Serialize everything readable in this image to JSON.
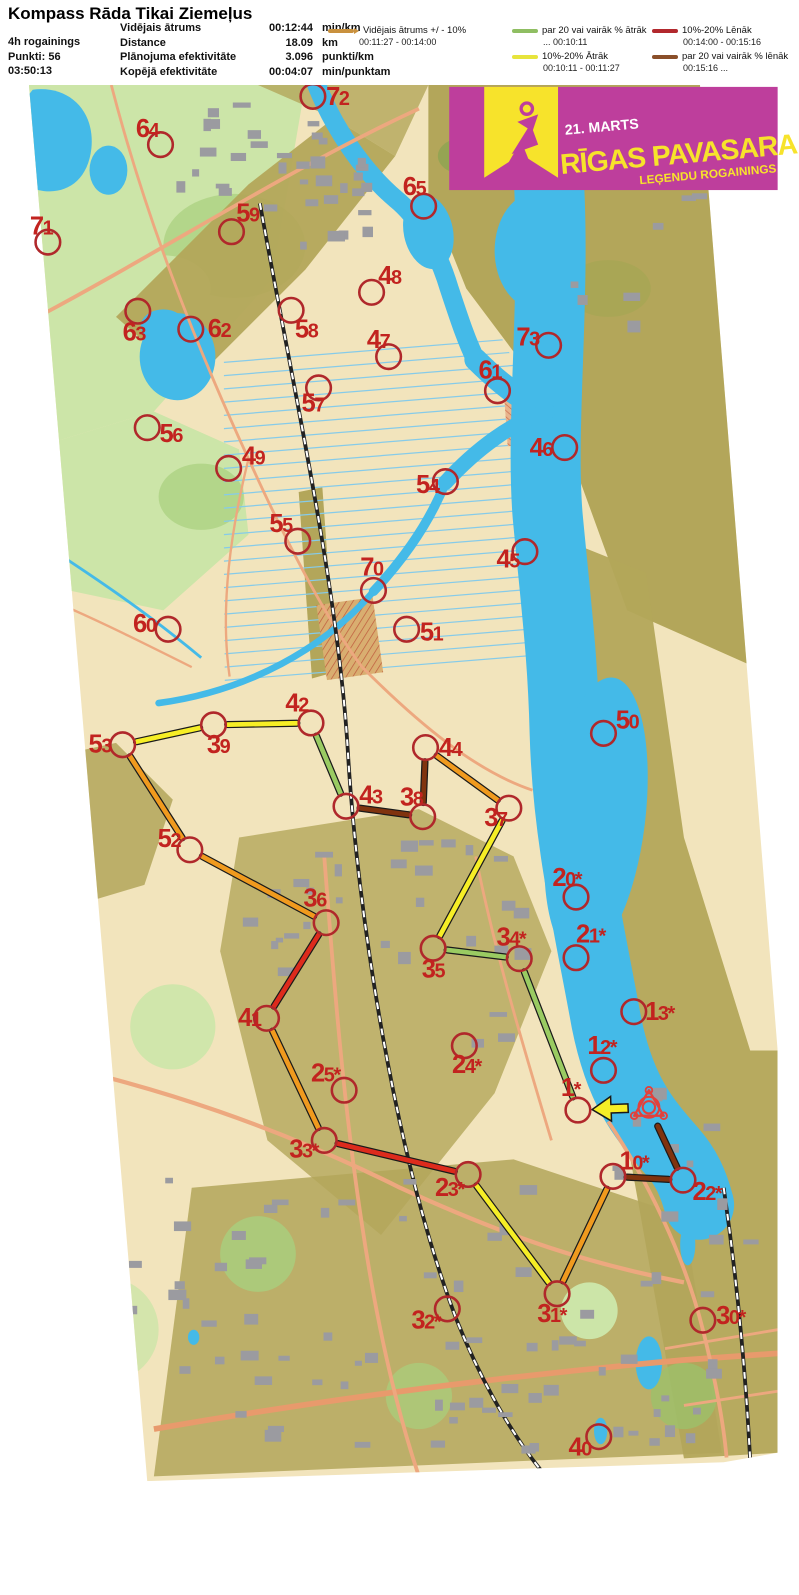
{
  "header": {
    "title": "Kompass Rāda Tikai Ziemeļus",
    "left": [
      "4h rogainings",
      "Punkti: 56",
      "03:50:13"
    ],
    "stats": [
      {
        "label": "Vidējais ātrums",
        "value": "00:12:44",
        "unit": "min/km"
      },
      {
        "label": "Distance",
        "value": "18.09",
        "unit": "km"
      },
      {
        "label": "Plānojuma efektivitāte",
        "value": "3.096",
        "unit": "punkti/km"
      },
      {
        "label": "Kopējā efektivitāte",
        "value": "00:04:07",
        "unit": "min/punktam"
      }
    ],
    "legend": [
      {
        "label": "Vidējais ātrums +/ - 10%",
        "range": "00:11:27  -  00:14:00",
        "color": "#C9913E"
      },
      {
        "label": "par 20 vai vairāk % ātrāk",
        "range": "...  00:10:11",
        "color": "#8FBE62"
      },
      {
        "label": "10%-20% Ātrāk",
        "range": "00:10:11  -  00:11:27",
        "color": "#E7E43C"
      },
      {
        "label": "10%-20% Lēnāk",
        "range": "00:14:00  -  00:15:16",
        "color": "#B2282D"
      },
      {
        "label": "par 20 vai vairāk % lēnāk",
        "range": "00:15:16  ...",
        "color": "#8A4F2A"
      }
    ]
  },
  "banner": {
    "date": "21. MARTS",
    "title": "RĪGAS PAVASARA",
    "subtitle": "LEĢENDU ROGAININGS",
    "bg_color": "#BE3E9C",
    "accent_color": "#F7E32B"
  },
  "map": {
    "palette": {
      "orange": "#F09A1E",
      "yellow": "#F6EE26",
      "green": "#9ACB62",
      "red": "#DD2B1C",
      "brown": "#80330E",
      "circle": "#B0282B",
      "label": "#C2231F",
      "start": "#E2413C"
    },
    "start_finish": {
      "x": 663,
      "y": 1165
    },
    "controls": [
      {
        "id": "71",
        "x": 28,
        "y": 251,
        "lx": 9,
        "ly": 243
      },
      {
        "id": "64",
        "x": 147,
        "y": 148,
        "lx": 121,
        "ly": 140
      },
      {
        "id": "72",
        "x": 308,
        "y": 97,
        "lx": 322,
        "ly": 106
      },
      {
        "id": "65",
        "x": 425,
        "y": 213,
        "lx": 403,
        "ly": 201
      },
      {
        "id": "59",
        "x": 222,
        "y": 240,
        "lx": 227,
        "ly": 229
      },
      {
        "id": "63",
        "x": 123,
        "y": 324,
        "lx": 107,
        "ly": 355
      },
      {
        "id": "62",
        "x": 179,
        "y": 343,
        "lx": 197,
        "ly": 351
      },
      {
        "id": "58",
        "x": 285,
        "y": 323,
        "lx": 289,
        "ly": 352
      },
      {
        "id": "48",
        "x": 370,
        "y": 304,
        "lx": 377,
        "ly": 295
      },
      {
        "id": "47",
        "x": 388,
        "y": 372,
        "lx": 365,
        "ly": 363
      },
      {
        "id": "73",
        "x": 557,
        "y": 360,
        "lx": 523,
        "ly": 360
      },
      {
        "id": "61",
        "x": 503,
        "y": 408,
        "lx": 483,
        "ly": 395
      },
      {
        "id": "57",
        "x": 314,
        "y": 405,
        "lx": 296,
        "ly": 430
      },
      {
        "id": "56",
        "x": 133,
        "y": 447,
        "lx": 146,
        "ly": 462
      },
      {
        "id": "49",
        "x": 219,
        "y": 490,
        "lx": 233,
        "ly": 486
      },
      {
        "id": "46",
        "x": 574,
        "y": 468,
        "lx": 537,
        "ly": 477
      },
      {
        "id": "54",
        "x": 448,
        "y": 504,
        "lx": 417,
        "ly": 516
      },
      {
        "id": "55",
        "x": 292,
        "y": 567,
        "lx": 262,
        "ly": 557
      },
      {
        "id": "45",
        "x": 532,
        "y": 578,
        "lx": 502,
        "ly": 595
      },
      {
        "id": "70",
        "x": 372,
        "y": 619,
        "lx": 358,
        "ly": 603
      },
      {
        "id": "60",
        "x": 155,
        "y": 660,
        "lx": 118,
        "ly": 663
      },
      {
        "id": "51",
        "x": 407,
        "y": 660,
        "lx": 421,
        "ly": 672
      },
      {
        "id": "50",
        "x": 615,
        "y": 770,
        "lx": 628,
        "ly": 765
      },
      {
        "id": "42",
        "x": 306,
        "y": 759,
        "lx": 279,
        "ly": 747
      },
      {
        "id": "39",
        "x": 203,
        "y": 761,
        "lx": 196,
        "ly": 791
      },
      {
        "id": "53",
        "x": 107,
        "y": 782,
        "lx": 71,
        "ly": 790
      },
      {
        "id": "44",
        "x": 427,
        "y": 785,
        "lx": 441,
        "ly": 794
      },
      {
        "id": "43",
        "x": 343,
        "y": 847,
        "lx": 357,
        "ly": 844
      },
      {
        "id": "38",
        "x": 424,
        "y": 858,
        "lx": 400,
        "ly": 846
      },
      {
        "id": "37",
        "x": 515,
        "y": 849,
        "lx": 489,
        "ly": 868
      },
      {
        "id": "52",
        "x": 178,
        "y": 893,
        "lx": 144,
        "ly": 890
      },
      {
        "id": "20*",
        "x": 586,
        "y": 943,
        "lx": 561,
        "ly": 931
      },
      {
        "id": "36",
        "x": 322,
        "y": 970,
        "lx": 298,
        "ly": 953
      },
      {
        "id": "34*",
        "x": 526,
        "y": 1008,
        "lx": 502,
        "ly": 994
      },
      {
        "id": "21*",
        "x": 586,
        "y": 1007,
        "lx": 586,
        "ly": 991
      },
      {
        "id": "35",
        "x": 435,
        "y": 997,
        "lx": 423,
        "ly": 1028
      },
      {
        "id": "13*",
        "x": 647,
        "y": 1064,
        "lx": 659,
        "ly": 1073
      },
      {
        "id": "41",
        "x": 259,
        "y": 1071,
        "lx": 229,
        "ly": 1079
      },
      {
        "id": "12*",
        "x": 615,
        "y": 1126,
        "lx": 598,
        "ly": 1109
      },
      {
        "id": "24*",
        "x": 468,
        "y": 1100,
        "lx": 455,
        "ly": 1129
      },
      {
        "id": "25*",
        "x": 341,
        "y": 1147,
        "lx": 306,
        "ly": 1138
      },
      {
        "id": "1*",
        "x": 588,
        "y": 1168,
        "lx": 570,
        "ly": 1153
      },
      {
        "id": "33*",
        "x": 320,
        "y": 1200,
        "lx": 283,
        "ly": 1218
      },
      {
        "id": "10*",
        "x": 625,
        "y": 1238,
        "lx": 632,
        "ly": 1231
      },
      {
        "id": "22*",
        "x": 699,
        "y": 1242,
        "lx": 709,
        "ly": 1263
      },
      {
        "id": "23*",
        "x": 472,
        "y": 1236,
        "lx": 437,
        "ly": 1259
      },
      {
        "id": "31*",
        "x": 566,
        "y": 1362,
        "lx": 545,
        "ly": 1392
      },
      {
        "id": "32*",
        "x": 450,
        "y": 1378,
        "lx": 412,
        "ly": 1399
      },
      {
        "id": "30*",
        "x": 720,
        "y": 1390,
        "lx": 734,
        "ly": 1394
      },
      {
        "id": "40",
        "x": 610,
        "y": 1513,
        "lx": 578,
        "ly": 1533
      }
    ],
    "route": [
      {
        "from": "start",
        "to": "1*",
        "speed": "yellow",
        "arrow": true
      },
      {
        "from": "1*",
        "to": "34*",
        "speed": "green"
      },
      {
        "from": "34*",
        "to": "35",
        "speed": "green"
      },
      {
        "from": "35",
        "to": "37",
        "speed": "yellow"
      },
      {
        "from": "37",
        "to": "44",
        "speed": "orange"
      },
      {
        "from": "44",
        "to": "38",
        "speed": "brown"
      },
      {
        "from": "38",
        "to": "43",
        "speed": "brown"
      },
      {
        "from": "43",
        "to": "42",
        "speed": "green"
      },
      {
        "from": "42",
        "to": "39",
        "speed": "yellow"
      },
      {
        "from": "39",
        "to": "53",
        "speed": "yellow"
      },
      {
        "from": "53",
        "to": "52",
        "speed": "orange"
      },
      {
        "from": "52",
        "to": "36",
        "speed": "orange"
      },
      {
        "from": "36",
        "to": "41",
        "speed": "red"
      },
      {
        "from": "41",
        "to": "33*",
        "speed": "orange"
      },
      {
        "from": "33*",
        "to": "23*",
        "speed": "red"
      },
      {
        "from": "23*",
        "to": "31*",
        "speed": "yellow"
      },
      {
        "from": "31*",
        "to": "10*",
        "speed": "orange"
      },
      {
        "from": "10*",
        "to": "22*",
        "speed": "brown"
      },
      {
        "from": "22*",
        "to": "start",
        "speed": "brown"
      }
    ]
  }
}
